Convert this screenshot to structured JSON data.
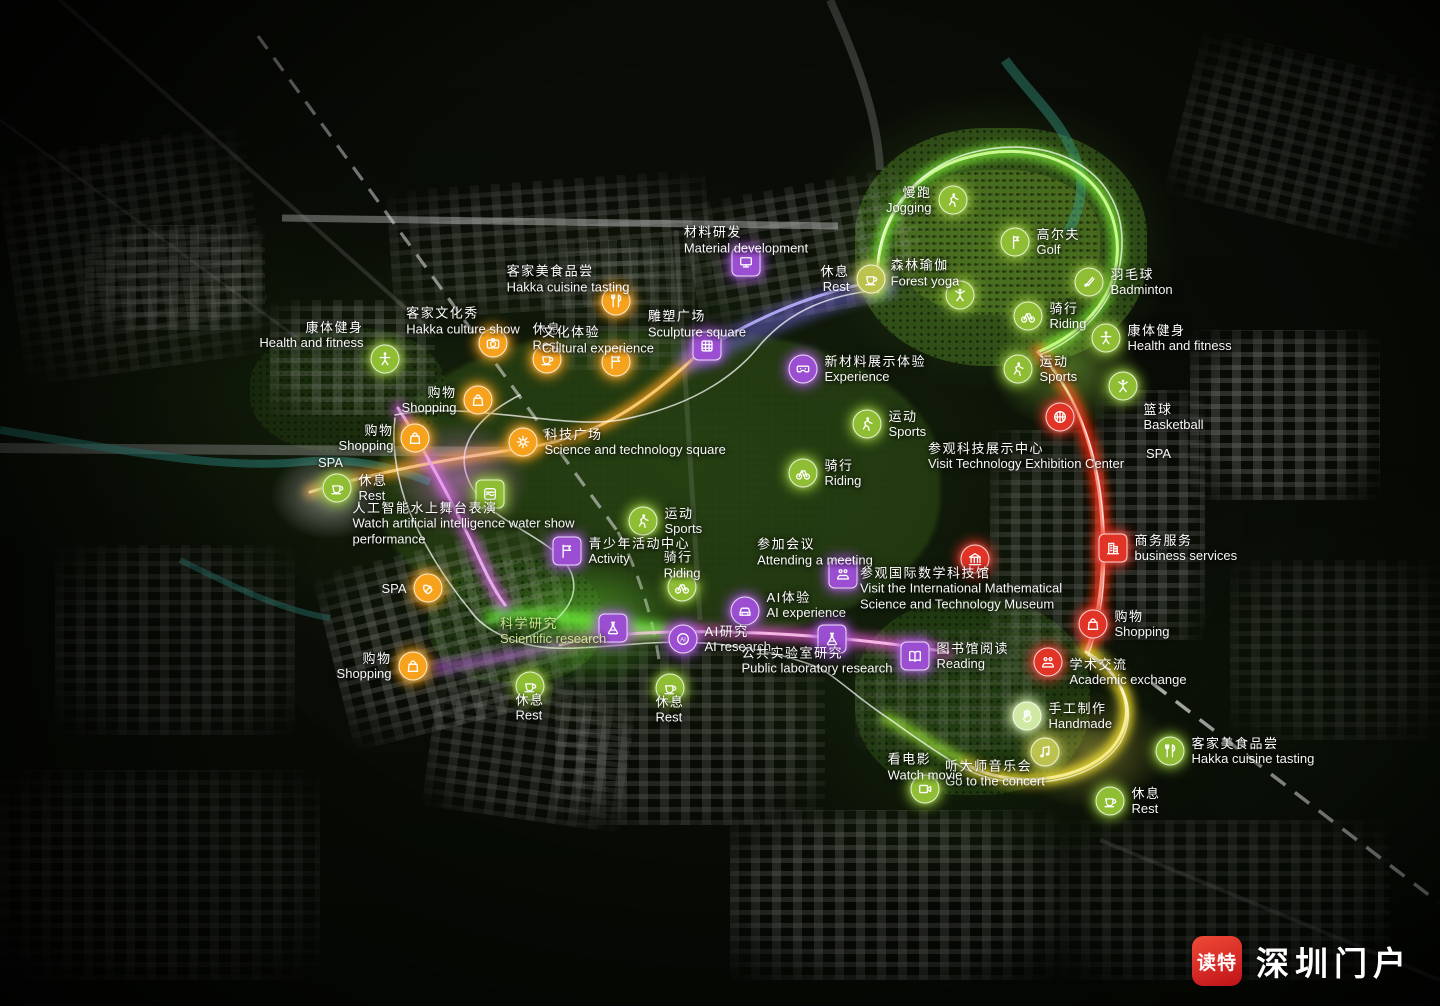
{
  "branding": {
    "app_badge": "读特",
    "site_name": "深圳门户"
  },
  "colors": {
    "green": "#8fbe34",
    "orange": "#f6a21d",
    "purple": "#9c4ed2",
    "red": "#e23327",
    "khaki": "#bcc24e",
    "mint": "#cfe9a4"
  },
  "pois": [
    {
      "name": "jogging",
      "zh": "慢跑",
      "en": "Jogging",
      "icon": "runner-icon",
      "color": "green",
      "x": 953,
      "y": 200,
      "side": "left"
    },
    {
      "name": "golf",
      "zh": "高尔夫",
      "en": "Golf",
      "icon": "golf-flag-icon",
      "color": "green",
      "x": 1015,
      "y": 242,
      "side": "right"
    },
    {
      "name": "forest-yoga",
      "zh": "森林瑜伽",
      "en": "Forest yoga",
      "icon": "yoga-icon",
      "color": "green",
      "x": 960,
      "y": 295,
      "side": "top",
      "dx": -35
    },
    {
      "name": "badminton",
      "zh": "羽毛球",
      "en": "Badminton",
      "icon": "shuttlecock-icon",
      "color": "green",
      "x": 1089,
      "y": 282,
      "side": "right"
    },
    {
      "name": "riding-top",
      "zh": "骑行",
      "en": "Riding",
      "icon": "bicycle-icon",
      "color": "green",
      "x": 1028,
      "y": 316,
      "side": "right"
    },
    {
      "name": "health-fitness-right",
      "zh": "康体健身",
      "en": "Health and fitness",
      "icon": "fitness-icon",
      "color": "green",
      "x": 1106,
      "y": 338,
      "side": "right"
    },
    {
      "name": "sports-right",
      "zh": "运动",
      "en": "Sports",
      "icon": "sports-icon",
      "color": "green",
      "x": 1018,
      "y": 369,
      "side": "right"
    },
    {
      "name": "dancer",
      "zh": "",
      "en": "",
      "icon": "dancer-icon",
      "color": "green",
      "x": 1123,
      "y": 386,
      "side": "right"
    },
    {
      "name": "basketball",
      "zh": "篮球",
      "en": "Basketball",
      "icon": "basketball-icon",
      "color": "red",
      "x": 1060,
      "y": 417,
      "side": "right",
      "dx": 62
    },
    {
      "name": "spa-right",
      "zh": "",
      "en": "SPA",
      "icon": null,
      "x": 1146,
      "y": 446
    },
    {
      "name": "business-services",
      "zh": "商务服务",
      "en": "business services",
      "icon": "building-icon",
      "color": "red",
      "shape": "square",
      "x": 1113,
      "y": 548,
      "side": "right"
    },
    {
      "name": "shopping-right",
      "zh": "购物",
      "en": "Shopping",
      "icon": "shopping-bag-icon",
      "color": "red",
      "x": 1093,
      "y": 624,
      "side": "right"
    },
    {
      "name": "academic-exchange",
      "zh": "学术交流",
      "en": "Academic exchange",
      "icon": "meeting-icon",
      "color": "red",
      "x": 1048,
      "y": 662,
      "side": "right",
      "dy": 10
    },
    {
      "name": "handmade",
      "zh": "手工制作",
      "en": "Handmade",
      "icon": "hand-icon",
      "color": "mint",
      "x": 1027,
      "y": 716,
      "side": "right"
    },
    {
      "name": "concert",
      "zh": "听大师音乐会",
      "en": "Go to the concert",
      "icon": "music-icon",
      "color": "khaki",
      "x": 1045,
      "y": 752,
      "side": "bottom",
      "dx": -50
    },
    {
      "name": "watch-movie",
      "zh": "看电影",
      "en": "Watch movie",
      "icon": "movie-icon",
      "color": "green",
      "x": 925,
      "y": 789,
      "side": "top"
    },
    {
      "name": "hakka-cuisine-right",
      "zh": "客家美食品尝",
      "en": "Hakka cuisine tasting",
      "icon": "cutlery-icon",
      "color": "green",
      "x": 1170,
      "y": 751,
      "side": "right"
    },
    {
      "name": "rest-bottom-right",
      "zh": "休息",
      "en": "Rest",
      "icon": "rest-cup-icon",
      "color": "green",
      "x": 1110,
      "y": 801,
      "side": "right"
    },
    {
      "name": "rest-center-bottom",
      "zh": "休息",
      "en": "Rest",
      "icon": "rest-cup-icon",
      "color": "green",
      "x": 670,
      "y": 688,
      "side": "bottom"
    },
    {
      "name": "rest-bottom-left",
      "zh": "休息",
      "en": "Rest",
      "icon": "rest-cup-icon",
      "color": "green",
      "x": 530,
      "y": 686,
      "side": "bottom"
    },
    {
      "name": "spa-bottom",
      "zh": "",
      "en": "SPA",
      "icon": "spa-leaf-icon",
      "color": "orange",
      "x": 428,
      "y": 588,
      "side": "left"
    },
    {
      "name": "shopping-bottom-left",
      "zh": "购物",
      "en": "Shopping",
      "icon": "shopping-bag-icon",
      "color": "orange",
      "x": 413,
      "y": 666,
      "side": "left"
    },
    {
      "name": "rest-left",
      "zh": "休息",
      "en": "Rest",
      "icon": "rest-cup-icon",
      "color": "green",
      "x": 337,
      "y": 488,
      "side": "right"
    },
    {
      "name": "spa-left",
      "zh": "",
      "en": "SPA",
      "icon": null,
      "x": 318,
      "y": 455
    },
    {
      "name": "shopping-left-lower",
      "zh": "购物",
      "en": "Shopping",
      "icon": "shopping-bag-icon",
      "color": "orange",
      "x": 415,
      "y": 438,
      "side": "left"
    },
    {
      "name": "shopping-left-upper",
      "zh": "购物",
      "en": "Shopping",
      "icon": "shopping-bag-icon",
      "color": "orange",
      "x": 478,
      "y": 400,
      "side": "left"
    },
    {
      "name": "health-fitness-left",
      "zh": "康体健身",
      "en": "Health and fitness",
      "icon": "fitness-icon",
      "color": "green",
      "x": 385,
      "y": 359,
      "side": "left",
      "dy": -24
    },
    {
      "name": "hakka-culture-show",
      "zh": "客家文化秀",
      "en": "Hakka culture show",
      "icon": "camera-icon",
      "color": "orange",
      "x": 493,
      "y": 343,
      "side": "top",
      "dx": -30
    },
    {
      "name": "rest-top-left",
      "zh": "休息",
      "en": "Rest",
      "icon": "rest-cup-icon",
      "color": "orange",
      "x": 547,
      "y": 359,
      "side": "top"
    },
    {
      "name": "hakka-cuisine-top",
      "zh": "客家美食品尝",
      "en": "Hakka cuisine tasting",
      "icon": "cutlery-icon",
      "color": "orange",
      "x": 616,
      "y": 301,
      "side": "top",
      "dx": -48
    },
    {
      "name": "cultural-experience",
      "zh": "文化体验",
      "en": "Cultural experience",
      "icon": "flag-icon",
      "color": "orange",
      "x": 616,
      "y": 362,
      "side": "top",
      "dx": -18
    },
    {
      "name": "sculpture-square",
      "zh": "雕塑广场",
      "en": "Sculpture square",
      "icon": "dome-icon",
      "color": "purple",
      "shape": "square",
      "x": 707,
      "y": 346,
      "side": "top",
      "dx": -10
    },
    {
      "name": "material-development",
      "zh": "材料研发",
      "en": "Material development",
      "icon": "monitor-icon",
      "color": "purple",
      "shape": "square",
      "x": 746,
      "y": 262,
      "side": "top"
    },
    {
      "name": "rest-top",
      "zh": "休息",
      "en": "Rest",
      "icon": "rest-cup-icon",
      "color": "khaki",
      "x": 871,
      "y": 279,
      "side": "left"
    },
    {
      "name": "experience-materials",
      "zh": "新材料展示体验",
      "en": "Experience",
      "icon": "vr-goggles-icon",
      "color": "purple",
      "x": 803,
      "y": 369,
      "side": "right"
    },
    {
      "name": "sports-center",
      "zh": "运动",
      "en": "Sports",
      "icon": "sports-icon",
      "color": "green",
      "x": 867,
      "y": 424,
      "side": "right"
    },
    {
      "name": "riding-center",
      "zh": "骑行",
      "en": "Riding",
      "icon": "bicycle-icon",
      "color": "green",
      "x": 803,
      "y": 473,
      "side": "right"
    },
    {
      "name": "sports-lower",
      "zh": "运动",
      "en": "Sports",
      "icon": "sports-icon",
      "color": "green",
      "x": 643,
      "y": 521,
      "side": "right"
    },
    {
      "name": "riding-lower",
      "zh": "骑行",
      "en": "Riding",
      "icon": "bicycle-icon",
      "color": "green",
      "x": 682,
      "y": 587,
      "side": "top"
    },
    {
      "name": "attending-meeting",
      "zh": "参加会议",
      "en": "Attending a meeting",
      "icon": "meeting-icon",
      "color": "purple",
      "shape": "square",
      "x": 843,
      "y": 574,
      "side": "top",
      "dx": -28
    },
    {
      "name": "activity-center",
      "zh": "青少年活动中心",
      "en": "Activity",
      "icon": "activity-flag-icon",
      "color": "purple",
      "shape": "square",
      "x": 567,
      "y": 551,
      "side": "right"
    },
    {
      "name": "water-show",
      "zh": "人工智能水上舞台表演",
      "en": "Watch artificial intelligence water show performance",
      "icon": "stage-icon",
      "color": "green",
      "shape": "square",
      "x": 490,
      "y": 494,
      "side": "bottom",
      "w": 235,
      "dx": -20
    },
    {
      "name": "science-square",
      "zh": "科技广场",
      "en": "Science and technology square",
      "icon": "gear-icon",
      "color": "orange",
      "x": 523,
      "y": 442,
      "side": "right"
    },
    {
      "name": "visit-tech-center",
      "zh": "参观科技展示中心",
      "en": "Visit Technology Exhibition Center",
      "icon": null,
      "x": 928,
      "y": 441
    },
    {
      "name": "math-museum",
      "zh": "参观国际数学科技馆",
      "en": "Visit the International Mathematical Science and Technology Museum",
      "icon": "museum-icon",
      "color": "red",
      "x": 975,
      "y": 559,
      "side": "bottom",
      "w": 230
    },
    {
      "name": "reading",
      "zh": "图书馆阅读",
      "en": "Reading",
      "icon": "book-icon",
      "color": "purple",
      "shape": "square",
      "x": 915,
      "y": 656,
      "side": "right"
    },
    {
      "name": "ai-experience",
      "zh": "AI体验",
      "en": "AI experience",
      "icon": "car-icon",
      "color": "purple",
      "x": 745,
      "y": 611,
      "side": "right",
      "dy": -6
    },
    {
      "name": "ai-research",
      "zh": "AI研究",
      "en": "AI research",
      "icon": "ai-brain-icon",
      "color": "purple",
      "x": 683,
      "y": 639,
      "side": "right"
    },
    {
      "name": "public-lab",
      "zh": "公共实验室研究",
      "en": "Public laboratory research",
      "icon": "flask-icon",
      "color": "purple",
      "shape": "square",
      "x": 832,
      "y": 639,
      "side": "bottom",
      "dx": -15
    },
    {
      "name": "microscope",
      "zh": "",
      "en": "",
      "icon": "microscope-icon",
      "color": "purple",
      "shape": "square",
      "x": 613,
      "y": 628,
      "side": "right"
    },
    {
      "name": "scientific-research",
      "zh": "科学研究",
      "en": "Scientific research",
      "icon": null,
      "x": 500,
      "y": 616,
      "tint": "green"
    }
  ]
}
